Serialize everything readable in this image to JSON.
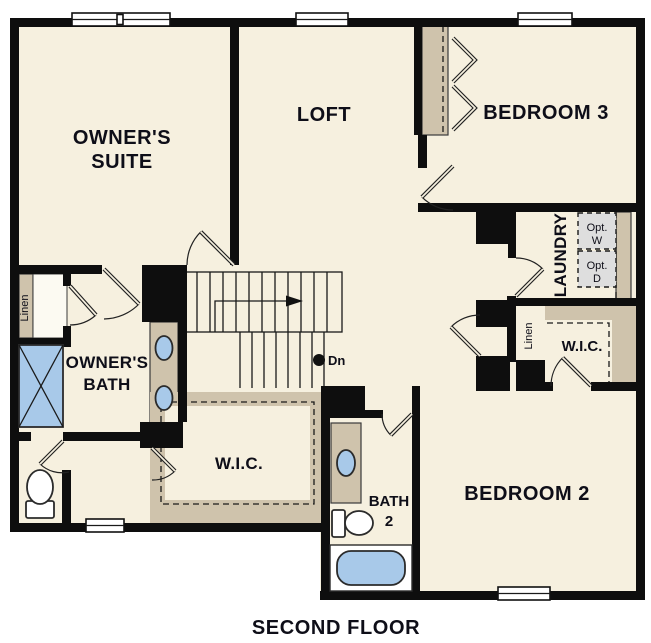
{
  "title": {
    "label": "SECOND FLOOR"
  },
  "colors": {
    "floor": "#F6F0DF",
    "wall": "#0E0E0E",
    "cabinet": "#CFC3AC",
    "fixture": "#A8C9E9",
    "appliance": "#DEDEDE",
    "ink": "#0E0E18",
    "paper": "#FFFFFF"
  },
  "rooms": {
    "owners_suite": {
      "line1": "OWNER'S",
      "line2": "SUITE"
    },
    "loft": {
      "label": "LOFT"
    },
    "bedroom3": {
      "label": "BEDROOM 3"
    },
    "laundry": {
      "label": "LAUNDRY"
    },
    "bedroom2": {
      "label": "BEDROOM 2"
    },
    "owners_bath": {
      "line1": "OWNER'S",
      "line2": "BATH"
    },
    "bath2": {
      "line1": "BATH",
      "line2": "2"
    }
  },
  "closets": {
    "linen_left": {
      "label": "Linen"
    },
    "linen_right": {
      "label": "Linen"
    },
    "wic_center": {
      "label": "W.I.C."
    },
    "wic_right": {
      "label": "W.I.C."
    }
  },
  "appliances": {
    "opt_washer": {
      "line1": "Opt.",
      "line2": "W"
    },
    "opt_dryer": {
      "line1": "Opt.",
      "line2": "D"
    }
  },
  "stairs": {
    "down_label": "Dn"
  }
}
